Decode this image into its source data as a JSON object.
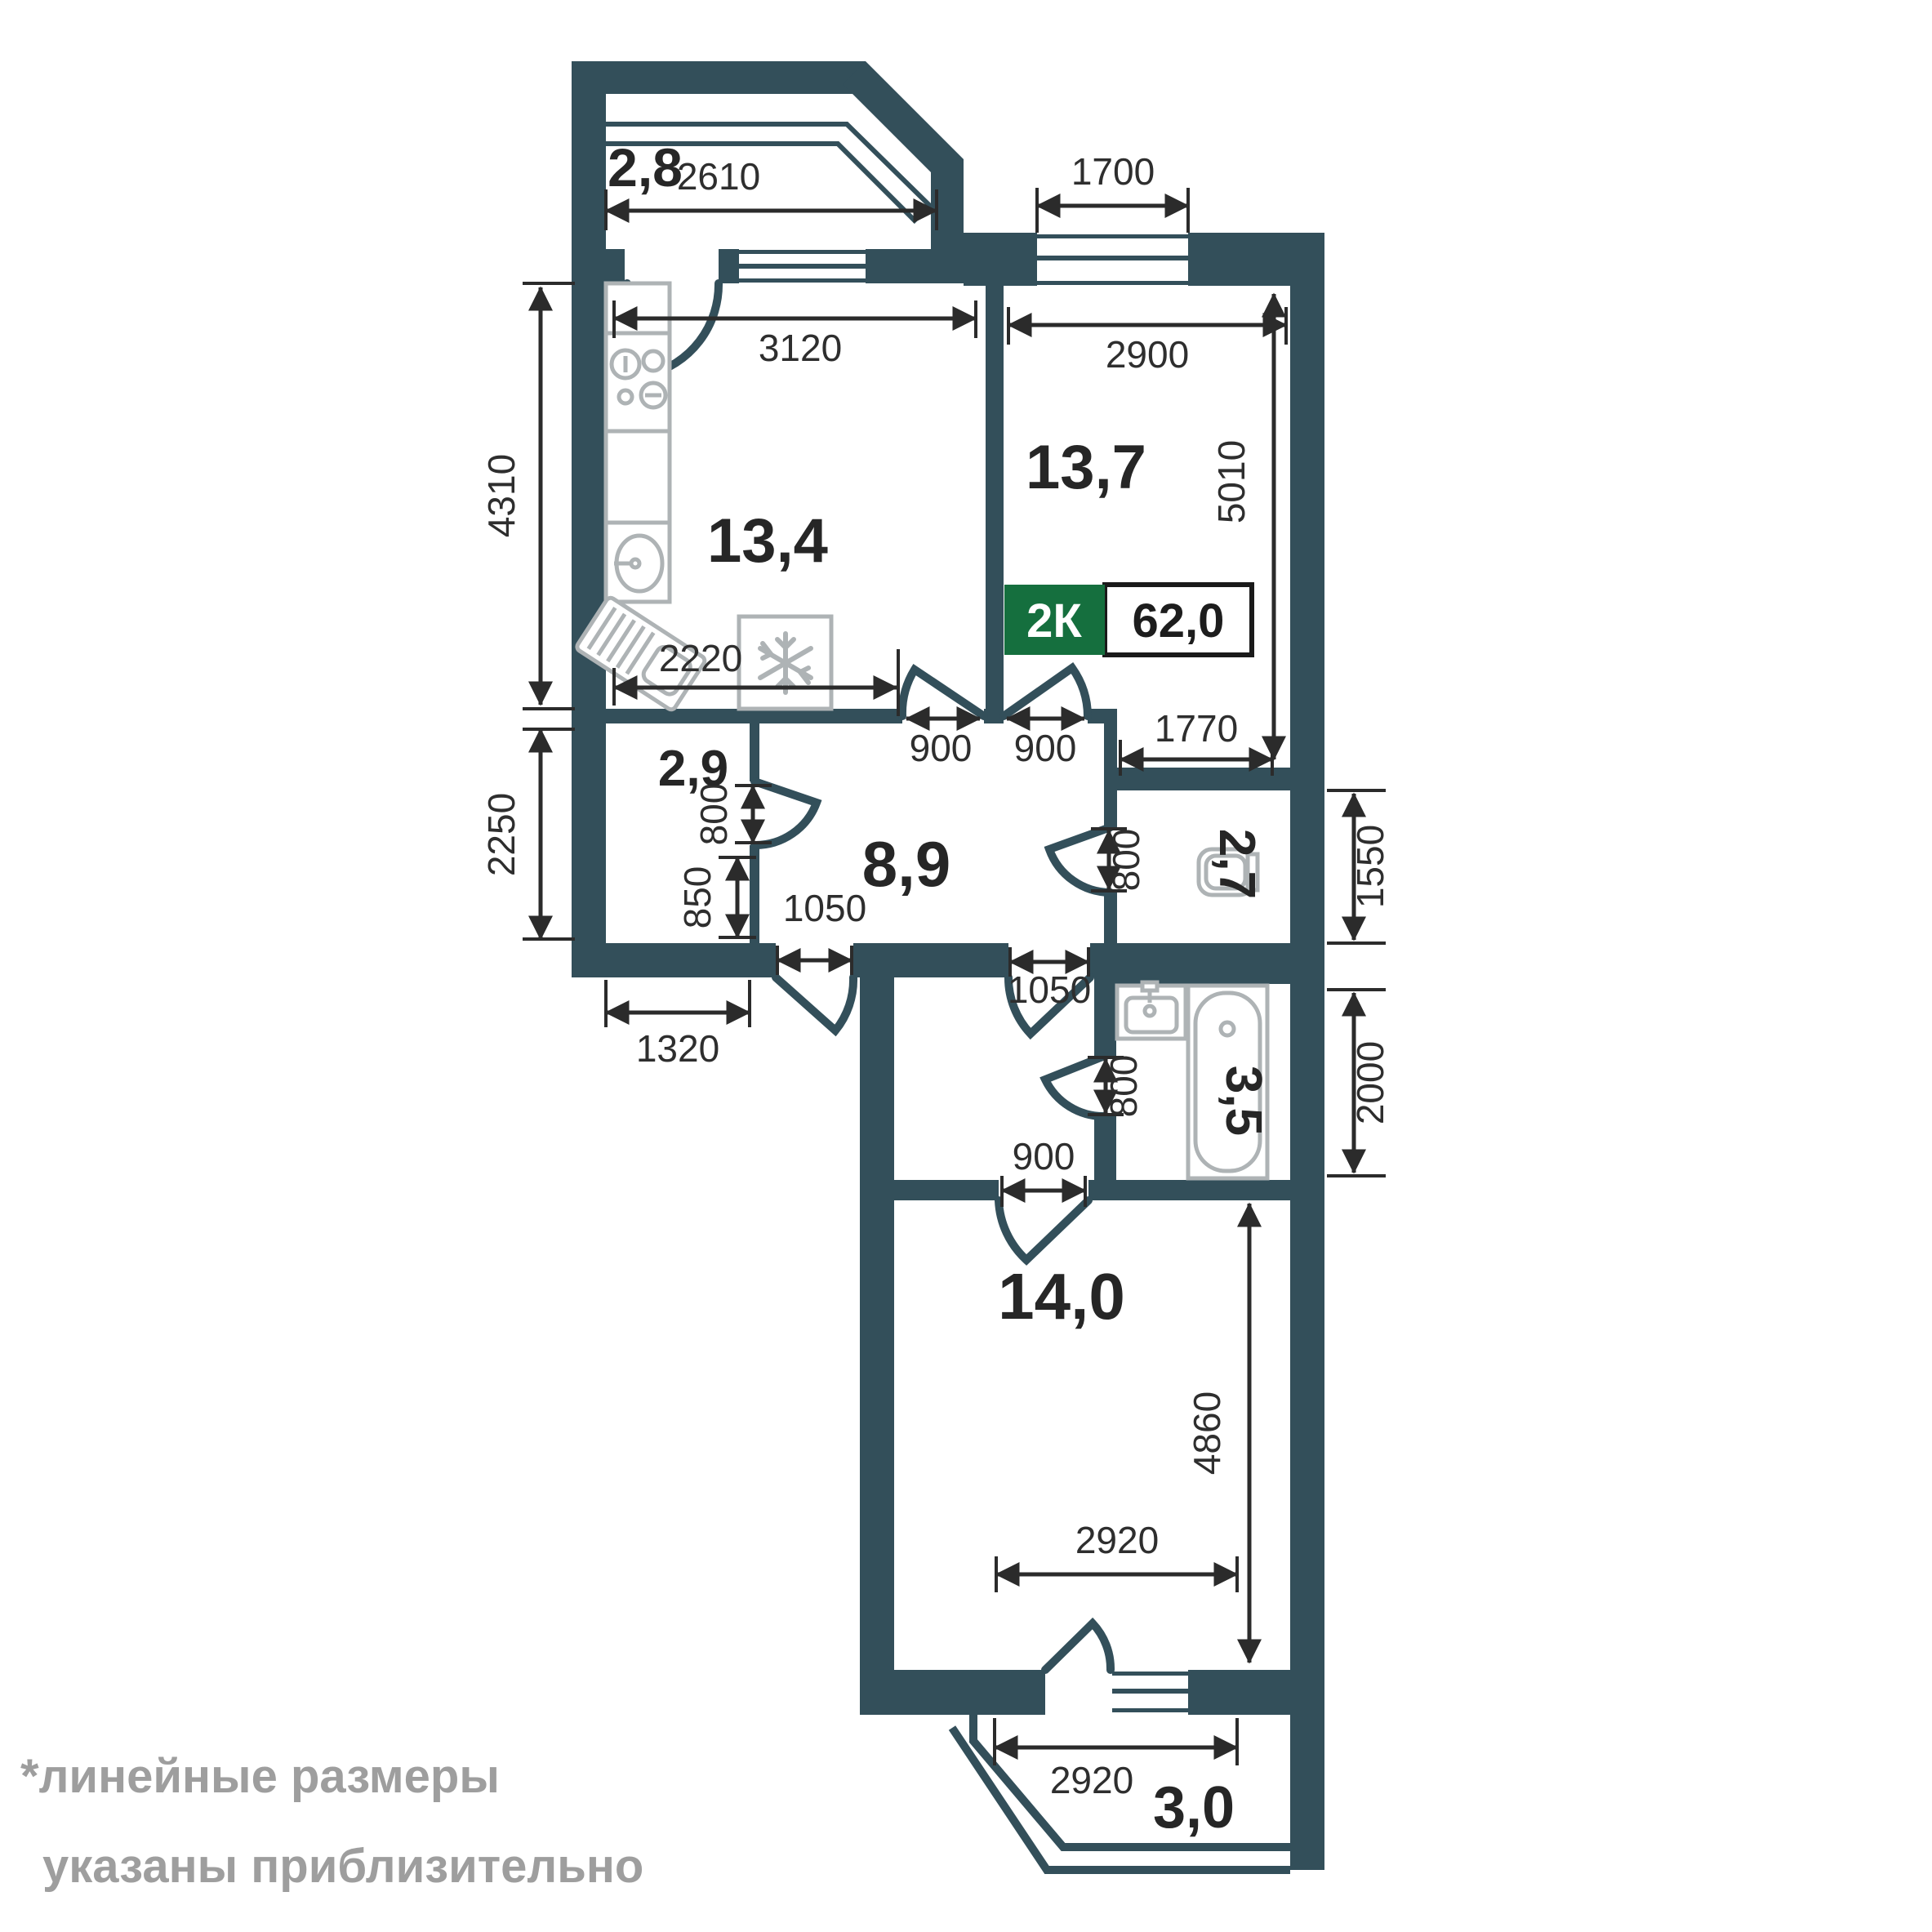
{
  "badge": {
    "type": "2К",
    "area": "62,0"
  },
  "rooms": {
    "balcony_top": {
      "area": "2,8"
    },
    "kitchen": {
      "area": "13,4"
    },
    "living": {
      "area": "13,7"
    },
    "wardrobe": {
      "area": "2,9"
    },
    "hallway": {
      "area": "8,9"
    },
    "wc": {
      "area": "2,7"
    },
    "bathroom": {
      "area": "3,5"
    },
    "bedroom": {
      "area": "14,0"
    },
    "balcony_bottom": {
      "area": "3,0"
    }
  },
  "dims": {
    "balcony_top_width": "2610",
    "living_window_width": "1700",
    "kitchen_width": "3120",
    "living_width": "2900",
    "kitchen_depth": "4310",
    "living_depth": "5010",
    "kitchen_counter_width": "2220",
    "kitchen_door_width": "900",
    "living_door_width": "900",
    "living_nook_width": "1770",
    "wardrobe_depth": "2250",
    "wardrobe_door_height": "800",
    "wardrobe_wall_rest": "850",
    "entrance_door_width": "1050",
    "inner_door_width": "1050",
    "wardrobe_width": "1320",
    "wc_depth": "1550",
    "wc_door_width": "800",
    "bathroom_depth": "2000",
    "bathroom_door_width": "800",
    "bedroom_door_width": "900",
    "bedroom_width": "2920",
    "bedroom_depth": "4860",
    "balcony_bottom_width": "2920"
  },
  "footnote": {
    "line1": "*линейные размеры",
    "line2": "указаны приблизительно"
  },
  "colors": {
    "wall": "#334F5A",
    "green": "#156F3E",
    "dim": "#2B2B2B",
    "area": "#262626",
    "fixture": "#AEB3B5",
    "footnote": "#9E9E9E"
  }
}
